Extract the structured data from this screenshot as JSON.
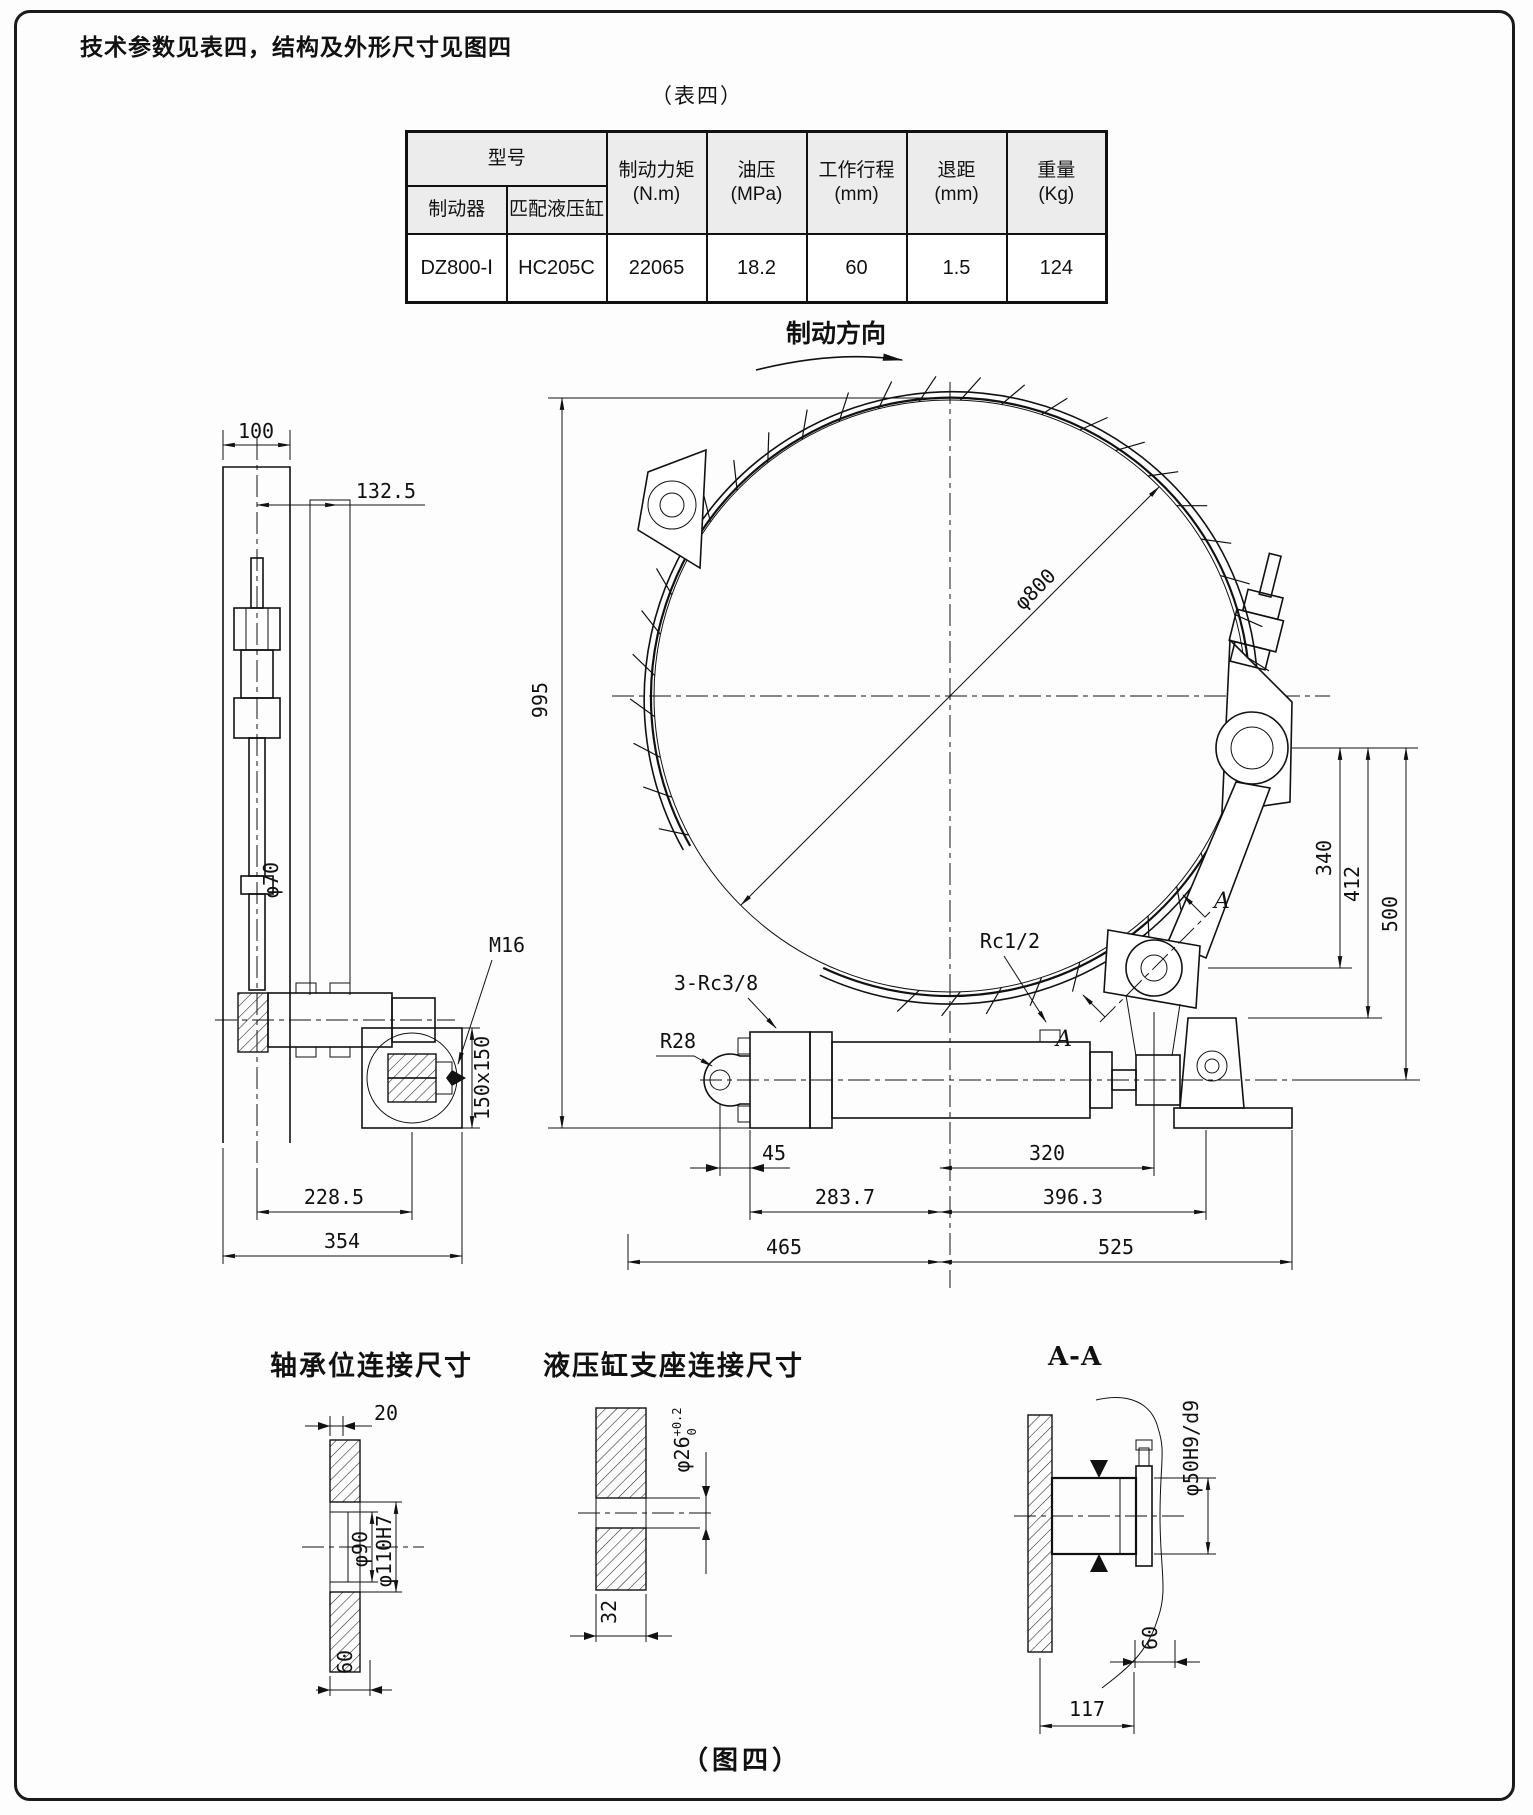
{
  "page": {
    "top_note": "技术参数见表四，结构及外形尺寸见图四",
    "table_caption": "（表四）",
    "figure_caption": "（图四）"
  },
  "table": {
    "header": {
      "model_group": "型号",
      "brake": "制动器",
      "cylinder": "匹配液压缸",
      "torque_l1": "制动力矩",
      "torque_l2": "(N.m)",
      "pressure_l1": "油压",
      "pressure_l2": "(MPa)",
      "stroke_l1": "工作行程",
      "stroke_l2": "(mm)",
      "retreat_l1": "退距",
      "retreat_l2": "(mm)",
      "weight_l1": "重量",
      "weight_l2": "(Kg)"
    },
    "row": {
      "brake_model": "DZ800-Ⅰ",
      "cylinder_model": "HC205C",
      "torque": "22065",
      "pressure": "18.2",
      "stroke": "60",
      "retreat": "1.5",
      "weight": "124"
    }
  },
  "main_view": {
    "direction_label": "制动方向",
    "dims": {
      "diameter": "φ800",
      "height": "995",
      "d45": "45",
      "d320": "320",
      "d283": "283.7",
      "d396": "396.3",
      "d465": "465",
      "d525": "525",
      "d340": "340",
      "d412": "412",
      "d500": "500"
    },
    "labels": {
      "rc12": "Rc1/2",
      "rc38": "3-Rc3/8",
      "r28": "R28",
      "a": "A"
    }
  },
  "left_view": {
    "dims": {
      "d100": "100",
      "d132": "132.5",
      "d228": "228.5",
      "d354": "354",
      "phi70": "φ70",
      "plate": "150x150"
    },
    "labels": {
      "m16": "M16"
    }
  },
  "details": {
    "bearing": {
      "title": "轴承位连接尺寸",
      "d20": "20",
      "phi90": "φ90",
      "phi110": "φ110H7",
      "d60": "60"
    },
    "support": {
      "title": "液压缸支座连接尺寸",
      "phi26": "φ26",
      "tol_up": "+0.2",
      "tol_dn": "0",
      "d32": "32"
    },
    "section": {
      "title": "A-A",
      "phi50": "φ50H9/d9",
      "d60": "60",
      "d117": "117"
    }
  }
}
